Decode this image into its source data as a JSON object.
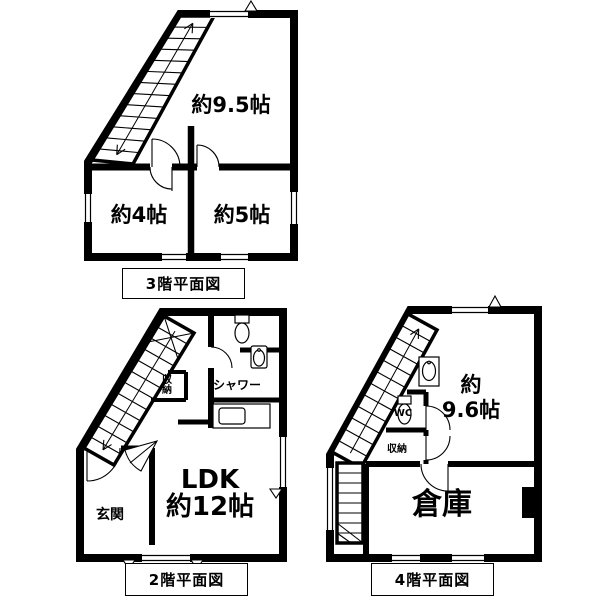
{
  "page": {
    "background": "#ffffff",
    "ink": "#000000"
  },
  "floor3": {
    "title": "3階平面図",
    "rooms": {
      "main": "約9.5帖",
      "west": "約4帖",
      "east": "約5帖"
    }
  },
  "floor2": {
    "title": "2階平面図",
    "rooms": {
      "ldk_line1": "LDK",
      "ldk_line2": "約12帖",
      "entrance": "玄関",
      "shower": "シャワー",
      "closet": "収納"
    }
  },
  "floor4": {
    "title": "4階平面図",
    "rooms": {
      "main_line1": "約",
      "main_line2": "9.6帖",
      "storage_room": "倉庫",
      "wc": "WC",
      "closet": "収納"
    }
  }
}
